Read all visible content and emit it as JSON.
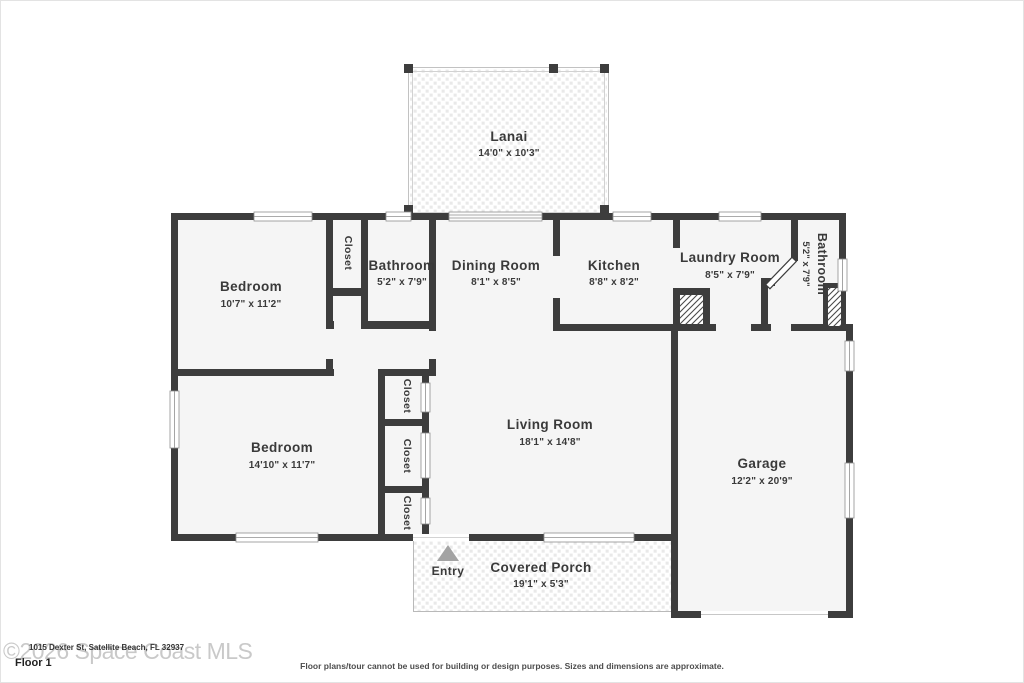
{
  "rooms": {
    "lanai": {
      "name": "Lanai",
      "dims": "14'0\" x 10'3\""
    },
    "bedroom1": {
      "name": "Bedroom",
      "dims": "10'7\" x 11'2\""
    },
    "closet1": {
      "name": "Closet"
    },
    "bathroom1": {
      "name": "Bathroom",
      "dims": "5'2\" x 7'9\""
    },
    "dining": {
      "name": "Dining Room",
      "dims": "8'1\" x 8'5\""
    },
    "kitchen": {
      "name": "Kitchen",
      "dims": "8'8\" x 8'2\""
    },
    "laundry": {
      "name": "Laundry Room",
      "dims": "8'5\" x 7'9\""
    },
    "bathroom2": {
      "name": "Bathroom",
      "dims": "5'2\" x 7'9\""
    },
    "bedroom2": {
      "name": "Bedroom",
      "dims": "14'10\" x 11'7\""
    },
    "closet2": {
      "name": "Closet"
    },
    "closet3": {
      "name": "Closet"
    },
    "closet4": {
      "name": "Closet"
    },
    "living": {
      "name": "Living Room",
      "dims": "18'1\" x 14'8\""
    },
    "garage": {
      "name": "Garage",
      "dims": "12'2\" x 20'9\""
    },
    "porch": {
      "name": "Covered Porch",
      "dims": "19'1\" x 5'3\""
    }
  },
  "labels": {
    "entry": "Entry",
    "floor": "Floor 1"
  },
  "footer": {
    "watermark": "©2026 Space Coast MLS",
    "address": "1015 Dexter St, Satellite Beach, FL 32937",
    "disclaimer": "Floor plans/tour cannot be used for building or design purposes. Sizes and dimensions are approximate."
  },
  "colors": {
    "wall": "#3d3d3d",
    "room_fill": "#f5f5f5",
    "text": "#3a3a3a",
    "tile": "#e9e9e9",
    "watermark": "#c9c9c9",
    "entry_arrow": "#a3a3a3"
  }
}
